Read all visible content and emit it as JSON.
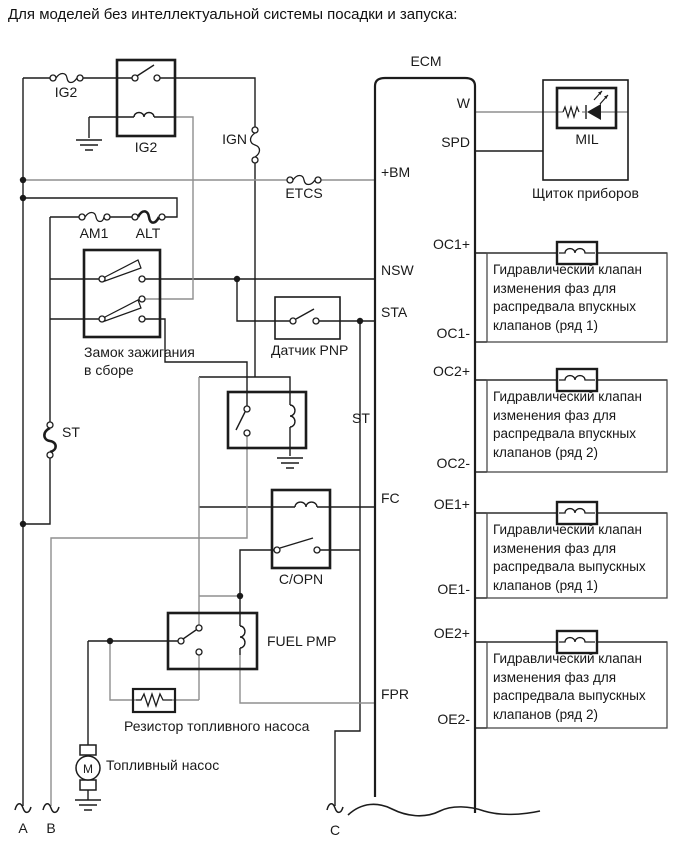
{
  "title": "Для моделей без интеллектуальной системы посадки и запуска:",
  "ecm": {
    "label": "ECM",
    "pins": {
      "bm": "+BM",
      "nsw": "NSW",
      "sta": "STA",
      "fc": "FC",
      "fpr": "FPR",
      "w": "W",
      "spd": "SPD",
      "oc1p": "OC1+",
      "oc1m": "OC1-",
      "oc2p": "OC2+",
      "oc2m": "OC2-",
      "oe1p": "OE1+",
      "oe1m": "OE1-",
      "oe2p": "OE2+",
      "oe2m": "OE2-"
    }
  },
  "fuses": {
    "ig2": "IG2",
    "ign": "IGN",
    "etcs": "ETCS",
    "am1": "AM1",
    "alt": "ALT",
    "st": "ST"
  },
  "relays": {
    "ig2": "IG2",
    "st": "ST",
    "copn": "C/OPN",
    "fuel_pump": "FUEL PMP"
  },
  "components": {
    "ignition_switch": "Замок зажигания в сборе",
    "pnp_sensor": "Датчик PNP",
    "fuel_pump_resistor": "Резистор топливного насоса",
    "fuel_pump": "Топливный насос",
    "motor_letter": "M",
    "mil": "MIL",
    "instrument_panel": "Щиток приборов"
  },
  "connectors": {
    "a": "A",
    "b": "B",
    "c": "C"
  },
  "valves": [
    {
      "text": "Гидравлический клапан изменения фаз для распредвала впускных клапанов (ряд 1)"
    },
    {
      "text": "Гидравлический клапан изменения фаз для распредвала впускных клапанов (ряд 2)"
    },
    {
      "text": "Гидравлический клапан изменения фаз для распредвала выпускных клапанов (ряд 1)"
    },
    {
      "text": "Гидравлический клапан изменения фаз для распредвала выпускных клапанов (ряд 2)"
    }
  ]
}
